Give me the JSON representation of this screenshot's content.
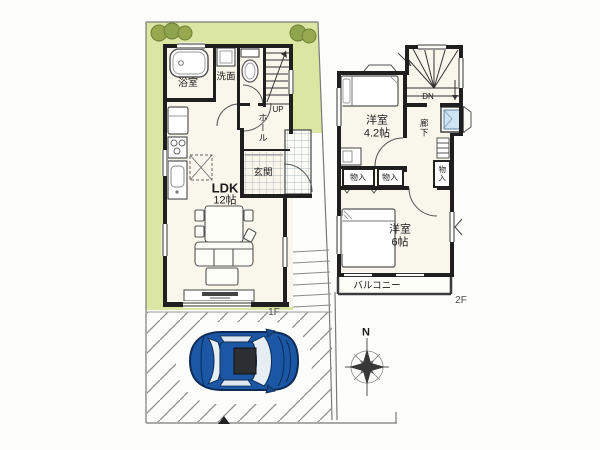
{
  "plan": {
    "floor1": {
      "floor_label": "1F",
      "bath_label": "浴室",
      "washroom_label": "洗面",
      "stairs_direction": "UP",
      "hall_label": "ホール",
      "entrance_label": "玄関",
      "ldk_name": "LDK",
      "ldk_size": "12帖"
    },
    "floor2": {
      "floor_label": "2F",
      "room_a_name": "洋室",
      "room_a_size": "4.2帖",
      "stairs_direction": "DN",
      "corridor_label": "廊下",
      "closet_a_label": "物入",
      "closet_b_label": "物入",
      "closet_c_label": "物入",
      "room_b_name": "洋室",
      "room_b_size": "6帖",
      "balcony_label": "バルコニー"
    },
    "compass": {
      "north_label": "N"
    },
    "colors": {
      "yard_green": "#dbe6a3",
      "tree_green": "#8ea54e",
      "wall_black": "#1f1f1f",
      "room_cream": "#f9f6ec",
      "car_blue": "#1c57a5",
      "car_glass": "#e6edf3",
      "basin_blue": "#cfe4f4",
      "hatch_gray": "#8f8f8f",
      "boundary_gray": "#7a7a7a"
    }
  }
}
